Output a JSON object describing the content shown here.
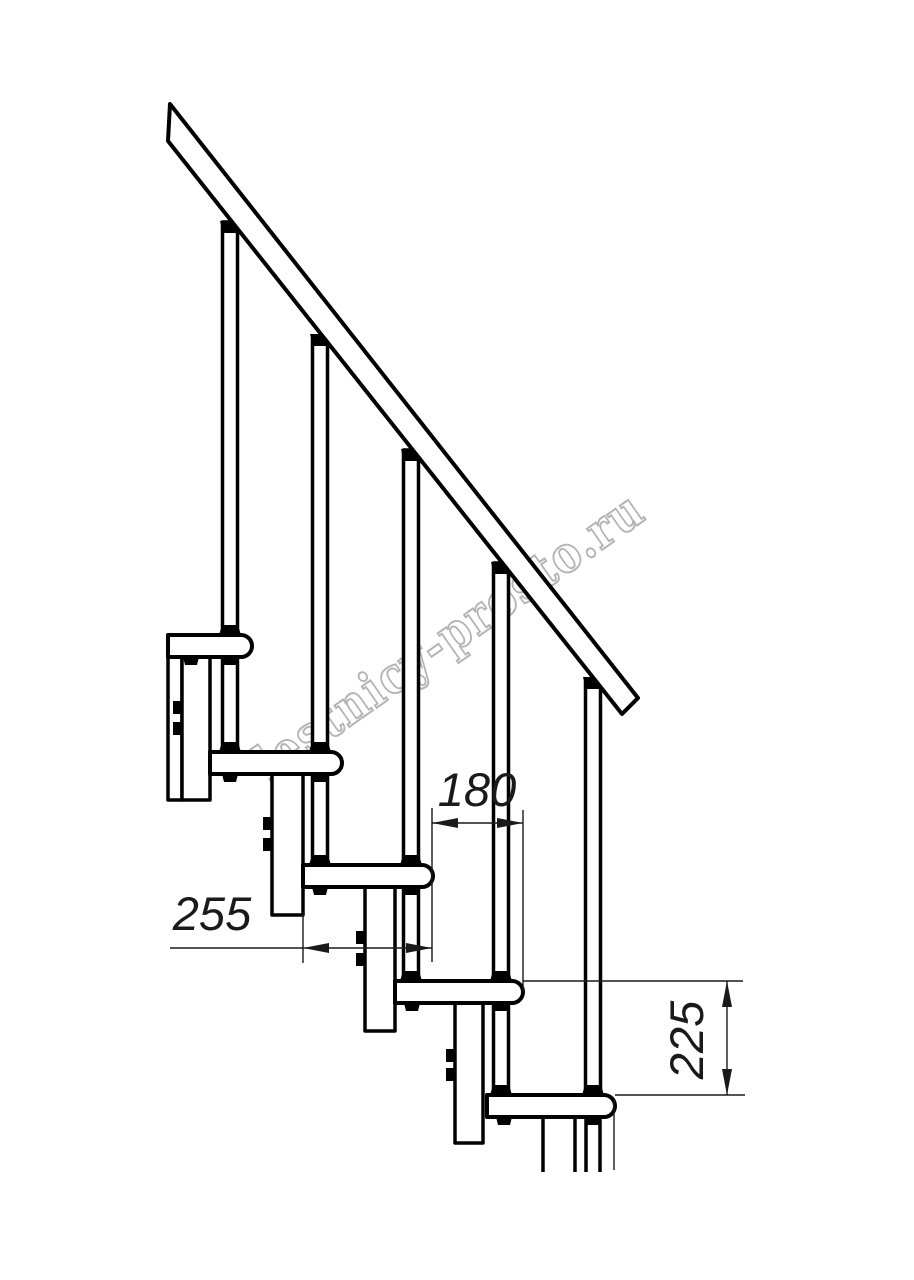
{
  "drawing": {
    "watermark_text": "lestnicy-prosto.ru",
    "dimensions": {
      "going_between_steps": "180",
      "tread_depth": "255",
      "riser_height": "225"
    },
    "colors": {
      "line": "#000000",
      "dimension_line": "#1a1a1a",
      "watermark_outline": "#b0b0b0",
      "background": "#ffffff"
    }
  }
}
